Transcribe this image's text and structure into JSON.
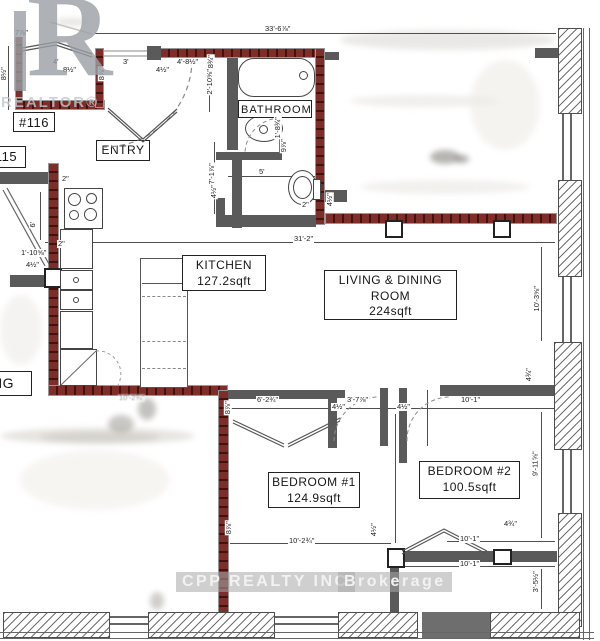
{
  "branding": {
    "logo_letter": "R",
    "logo_text": "REALTOR®",
    "watermark_1": "CPP REALTY INC",
    "watermark_2": "Brokerage"
  },
  "labels": {
    "unit": "#116",
    "adjacent_unit": "115",
    "adjacent_partial": "NG",
    "entry": "ENTRY",
    "bathroom": "BATHROOM",
    "kitchen_name": "KITCHEN",
    "kitchen_area": "127.2sqft",
    "living_line1": "LIVING & DINING",
    "living_line2": "ROOM",
    "living_area": "224sqft",
    "bedroom1_name": "BEDROOM #1",
    "bedroom1_area": "124.9sqft",
    "bedroom2_name": "BEDROOM #2",
    "bedroom2_area": "100.5sqft"
  },
  "colors": {
    "wall_red": "#7e2d29",
    "wall_gray": "#5a5a5a",
    "line": "#4f4f4f",
    "watermark_text": "#f2f2f2",
    "logo_gray": "#9aa0a5"
  },
  "dimensions": [
    {
      "text": "33'-6⅞\"",
      "x": 264,
      "y": 25
    },
    {
      "text": "7⅞\"",
      "x": 14,
      "y": 29
    },
    {
      "text": "8½\"",
      "x": -4,
      "y": 70,
      "rot": true
    },
    {
      "text": "4'",
      "x": 52,
      "y": 58
    },
    {
      "text": "8½\"",
      "x": 62,
      "y": 66
    },
    {
      "text": "3'",
      "x": 122,
      "y": 58
    },
    {
      "text": "4½\"",
      "x": 155,
      "y": 66
    },
    {
      "text": "4'-8½\"",
      "x": 176,
      "y": 58
    },
    {
      "text": "8⅞\"",
      "x": 94,
      "y": 70,
      "rot": true
    },
    {
      "text": "8¾\"",
      "x": 203,
      "y": 58,
      "rot": true
    },
    {
      "text": "2'-10⅝\"",
      "x": 196,
      "y": 78,
      "rot": true
    },
    {
      "text": "1'-8¾\"",
      "x": 266,
      "y": 124,
      "rot": true
    },
    {
      "text": "7'-1⅞\"",
      "x": 200,
      "y": 170,
      "rot": true
    },
    {
      "text": "4½\"",
      "x": 206,
      "y": 188,
      "rot": true
    },
    {
      "text": "5'",
      "x": 258,
      "y": 168
    },
    {
      "text": "2\"",
      "x": 301,
      "y": 201
    },
    {
      "text": "9⅞\"",
      "x": 276,
      "y": 142,
      "rot": true
    },
    {
      "text": "4½\"",
      "x": 322,
      "y": 196,
      "rot": true
    },
    {
      "text": "31'-2\"",
      "x": 293,
      "y": 235
    },
    {
      "text": "1'-10⅝\"",
      "x": 20,
      "y": 249
    },
    {
      "text": "4½\"",
      "x": 25,
      "y": 261
    },
    {
      "text": "2\"",
      "x": 61,
      "y": 175
    },
    {
      "text": "2\"",
      "x": 57,
      "y": 240
    },
    {
      "text": "6'",
      "x": 29,
      "y": 221,
      "rot": true
    },
    {
      "text": "10'-3⅝\"",
      "x": 523,
      "y": 295,
      "rot": true
    },
    {
      "text": "4¾\"",
      "x": 521,
      "y": 371,
      "rot": true
    },
    {
      "text": "10'-2¾\"",
      "x": 118,
      "y": 394,
      "faint": true
    },
    {
      "text": "8⅞\"",
      "x": 220,
      "y": 404,
      "rot": true
    },
    {
      "text": "6'-2¾\"",
      "x": 256,
      "y": 396
    },
    {
      "text": "4½\"",
      "x": 331,
      "y": 403
    },
    {
      "text": "3'-7⅞\"",
      "x": 346,
      "y": 396
    },
    {
      "text": "4½\"",
      "x": 396,
      "y": 403
    },
    {
      "text": "10'-1\"",
      "x": 460,
      "y": 396
    },
    {
      "text": "8⅞\"",
      "x": 221,
      "y": 524,
      "rot": true
    },
    {
      "text": "10'-2¾\"",
      "x": 288,
      "y": 537
    },
    {
      "text": "4½\"",
      "x": 366,
      "y": 526,
      "rot": true
    },
    {
      "text": "9'-11⅝\"",
      "x": 522,
      "y": 460,
      "rot": true
    },
    {
      "text": "4¾\"",
      "x": 503,
      "y": 520
    },
    {
      "text": "10'-1\"",
      "x": 459,
      "y": 535
    },
    {
      "text": "10'-1\"",
      "x": 459,
      "y": 560
    },
    {
      "text": "3'-5½\"",
      "x": 524,
      "y": 578,
      "rot": true
    }
  ]
}
